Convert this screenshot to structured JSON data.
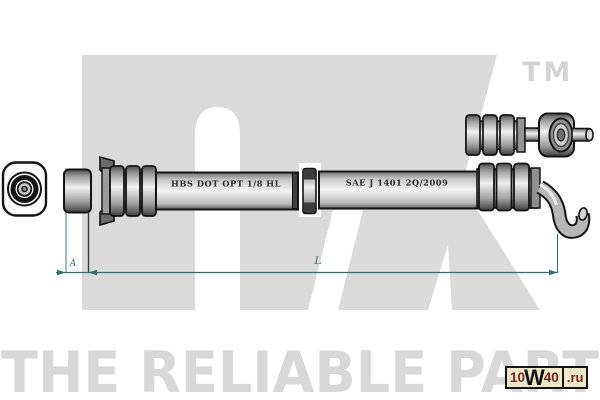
{
  "watermark": {
    "brand": "NK",
    "trademark": "TM",
    "tagline": "THE RELIABLE PART",
    "color": "#dadada"
  },
  "drawing": {
    "type": "technical-line-drawing",
    "subject": "brake hose assembly with end fittings",
    "hose_markings": [
      "HBS DOT OPT 1/8 HL",
      "SAE J 1401 2Q/2009"
    ]
  },
  "dimensions": {
    "a_label": "A",
    "l_label": "L",
    "line_color": "#2e6e6e"
  },
  "site_badge": {
    "text_10": "10",
    "text_w": "W",
    "text_40": "40",
    "text_domain": ".ru",
    "background": "#ece8c9",
    "accent": "#7d2020"
  }
}
